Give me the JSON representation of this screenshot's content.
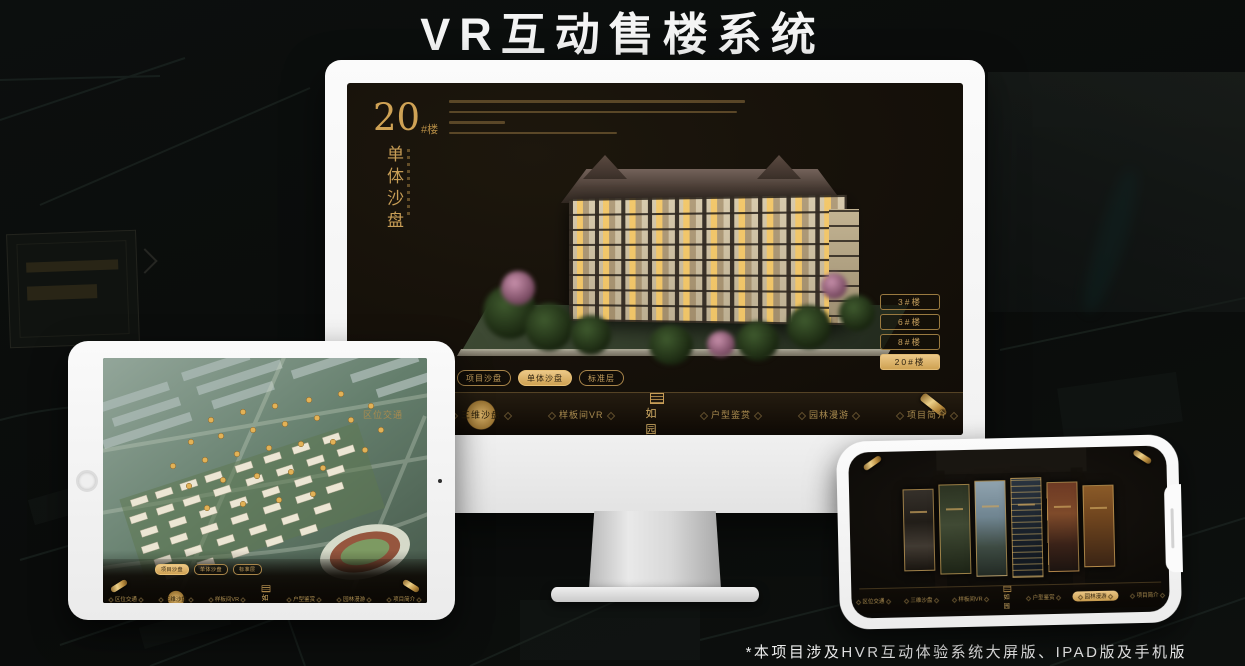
{
  "page": {
    "title": "VR互动售楼系统",
    "footnote": "*本项目涉及HVR互动体验系统大屏版、IPAD版及手机版"
  },
  "brand": {
    "logo": "如园"
  },
  "nav": {
    "items": [
      {
        "label": "区位交通"
      },
      {
        "label": "三维沙盘"
      },
      {
        "label": "样板间VR"
      },
      {
        "label": "户型鉴赏"
      },
      {
        "label": "园林漫游"
      },
      {
        "label": "项目简介"
      }
    ]
  },
  "subtabs": {
    "items": [
      {
        "label": "项目沙盘"
      },
      {
        "label": "单体沙盘"
      },
      {
        "label": "标准层"
      }
    ]
  },
  "monitor": {
    "headline": {
      "number": "20",
      "unit": "#楼",
      "title": "单体沙盘"
    },
    "buildings": [
      {
        "label": "3#楼"
      },
      {
        "label": "6#楼"
      },
      {
        "label": "8#楼"
      },
      {
        "label": "20#楼"
      }
    ]
  },
  "colors": {
    "gold": "#c9a25f",
    "gold_bright": "#ecc887",
    "screen_bg": "#16120b",
    "page_bg": "#0b0d0c",
    "device_white": "#f6f6f6"
  }
}
